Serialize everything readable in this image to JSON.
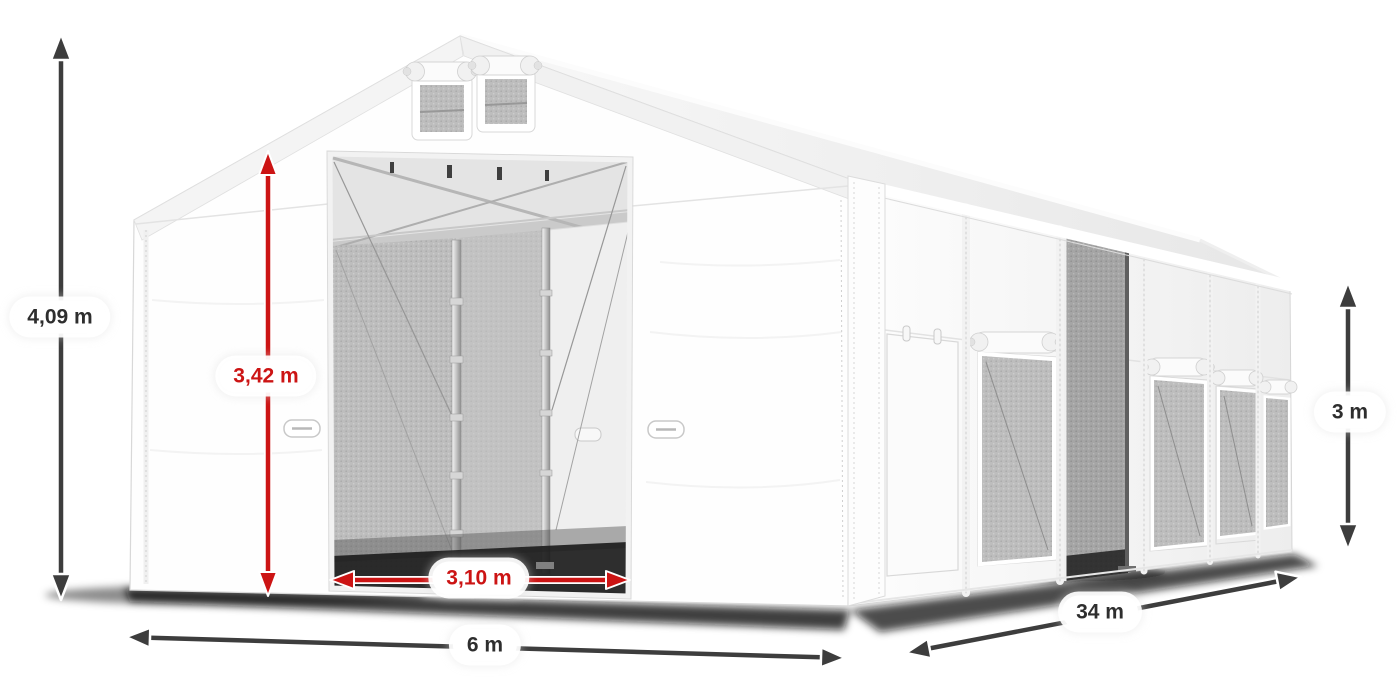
{
  "dimensions": {
    "total_height": {
      "label": "4,09 m"
    },
    "inner_height": {
      "label": "3,42 m"
    },
    "entrance_width": {
      "label": "3,10 m"
    },
    "front_width": {
      "label": "6 m"
    },
    "side_length": {
      "label": "34 m"
    },
    "wall_height": {
      "label": "3 m"
    }
  },
  "colors": {
    "outer_dimension": "#3d3d3d",
    "inner_dimension": "#cc1414",
    "label_background": "#ffffff",
    "label_text": "#2e2e2e"
  }
}
